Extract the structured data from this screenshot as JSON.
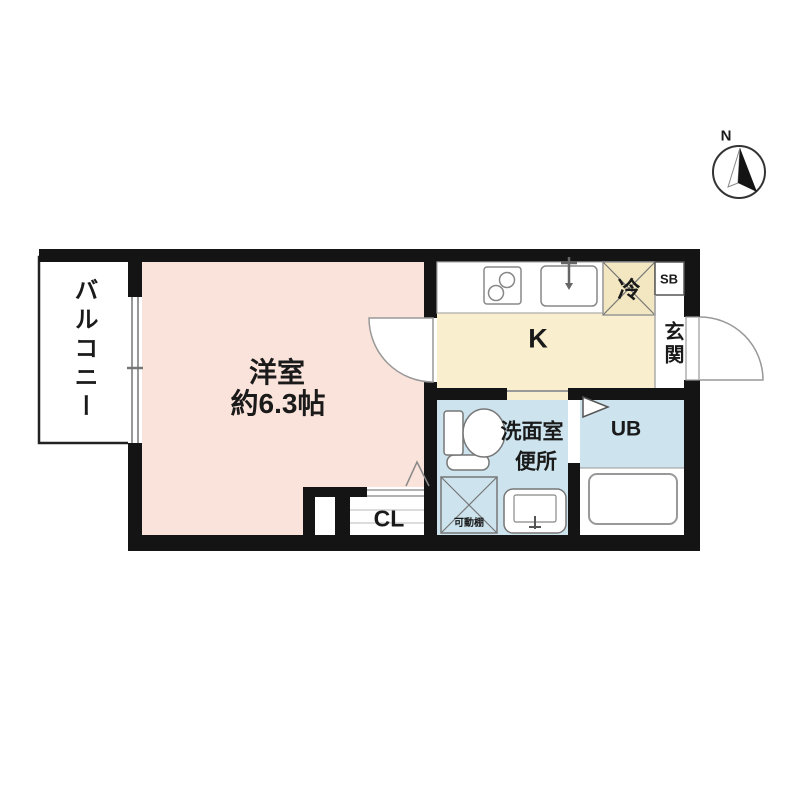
{
  "compass": {
    "north_label": "N"
  },
  "rooms": {
    "balcony": {
      "label": "バルコニー"
    },
    "living": {
      "label": "洋室",
      "size": "約6.3帖"
    },
    "kitchen": {
      "label": "K"
    },
    "refrigerator": {
      "label": "冷"
    },
    "shoe_box": {
      "label": "SB"
    },
    "entrance": {
      "label": "玄関"
    },
    "washroom": {
      "label_line1": "洗面室",
      "label_line2": "便所"
    },
    "movable_shelf": {
      "label": "可動棚"
    },
    "unit_bath": {
      "label": "UB"
    },
    "closet": {
      "label": "CL"
    }
  },
  "colors": {
    "living_fill": "#fae3da",
    "kitchen_fill": "#f9efce",
    "refrigerator_fill": "#f2e7c0",
    "wet_area_fill": "#cde4ef",
    "wall": "#141414"
  }
}
